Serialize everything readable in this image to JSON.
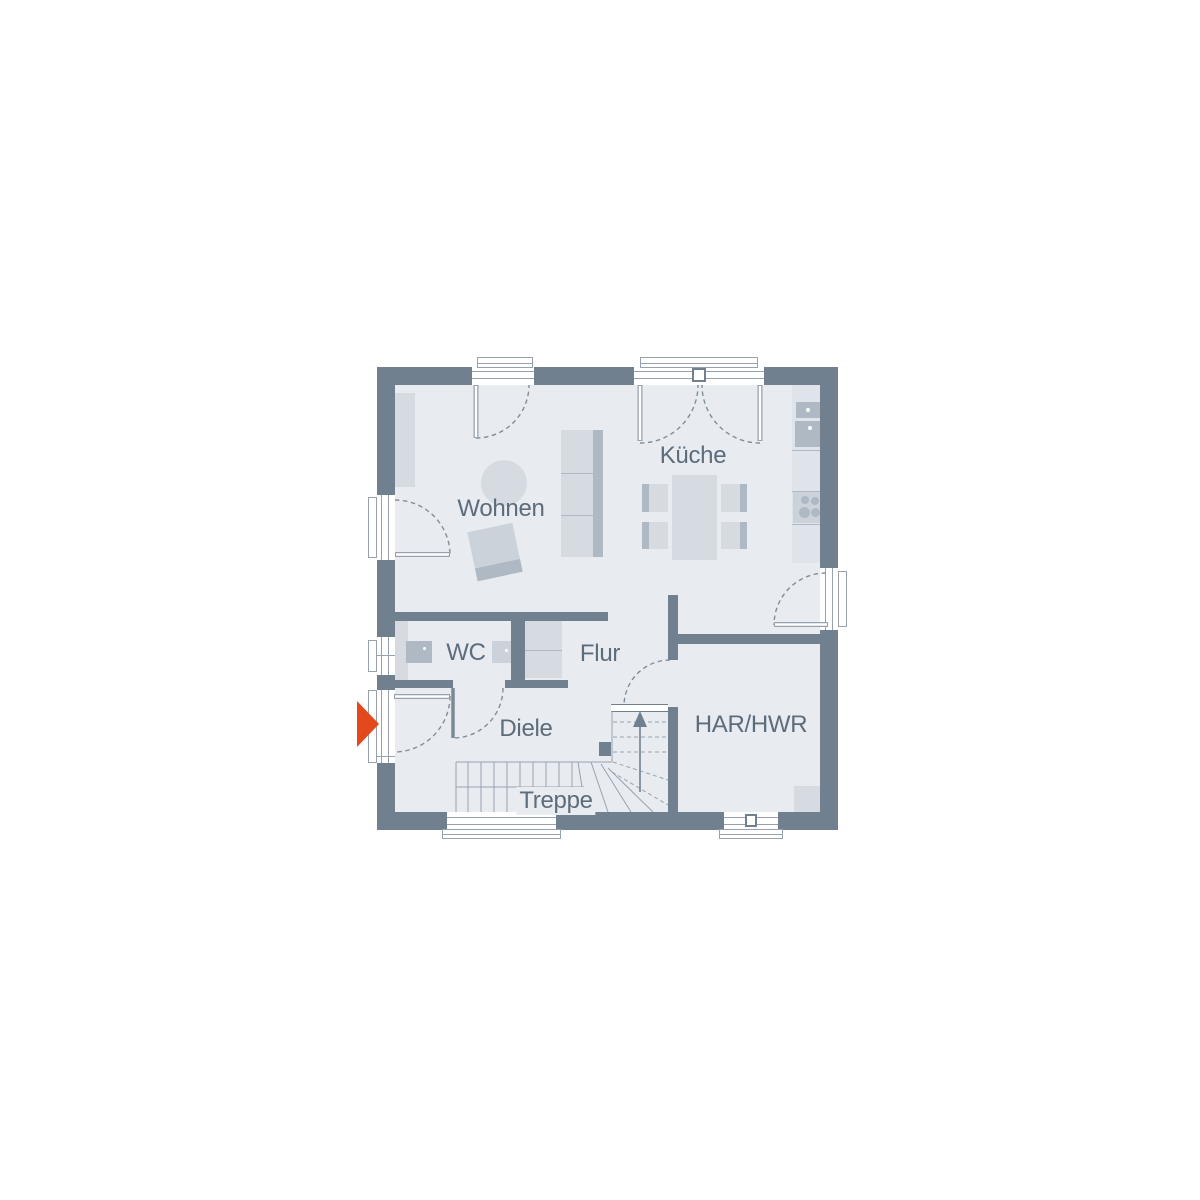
{
  "colors": {
    "wall": "#71808F",
    "floor": "#E8ECF1",
    "counter": "#DFE4EA",
    "furniture_light": "#D6DBE2",
    "furniture_mid": "#CBD2DA",
    "furniture_dark": "#AFB9C4",
    "frame_line": "#97A2AE",
    "dash_line": "#808E9B",
    "label_text": "#5D6C7B",
    "entrance_arrow": "#E3491A"
  },
  "rooms": {
    "wohnen": "Wohnen",
    "kueche": "Küche",
    "wc": "WC",
    "flur": "Flur",
    "diele": "Diele",
    "treppe": "Treppe",
    "har_hwr": "HAR/HWR"
  }
}
